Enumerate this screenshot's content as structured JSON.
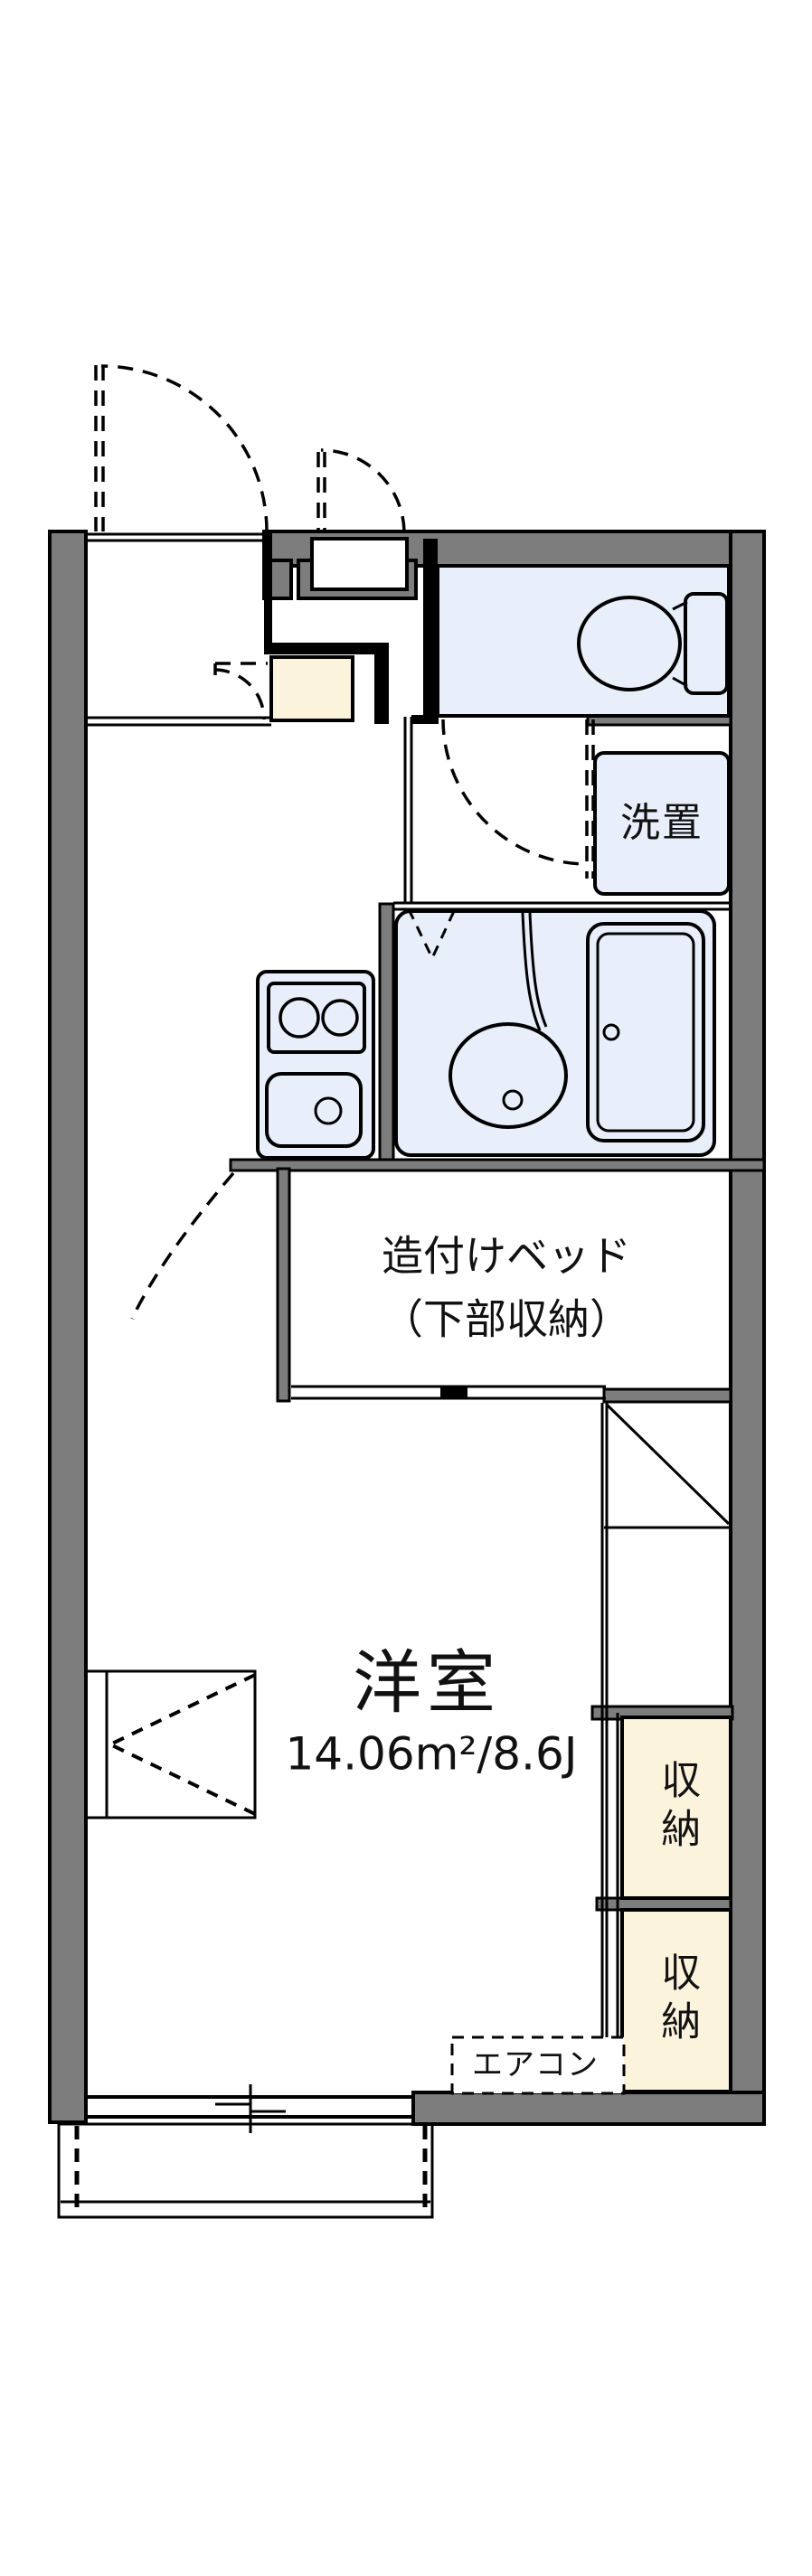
{
  "document": {
    "kind": "japanese-apartment-floor-plan"
  },
  "colors": {
    "wall_gray": "#7d7d7d",
    "fixture_fill": "#e8effb",
    "storage_fill": "#fcf3dd",
    "line_black": "#000000",
    "background": "#ffffff"
  },
  "labels": {
    "washstand": "洗置",
    "bed_line1": "造付けベッド",
    "bed_line2": "（下部収納）",
    "room_name": "洋室",
    "room_area": "14.06m²/8.6J",
    "storage_upper": "収納",
    "storage_lower": "収納",
    "aircon": "エアコン"
  },
  "rooms": [
    {
      "name": "toilet-room",
      "fill": "#e8effb"
    },
    {
      "name": "washstand-area",
      "label": "洗置",
      "fill": "#e8effb"
    },
    {
      "name": "bathroom-unit",
      "fill": "#e8effb"
    },
    {
      "name": "kitchen-area",
      "fill": "#ffffff"
    },
    {
      "name": "entrance-hall",
      "fill": "#ffffff"
    },
    {
      "name": "genkan-step",
      "fill": "#fcf3dd"
    },
    {
      "name": "built-in-bed",
      "label": "造付けベッド（下部収納）",
      "fill": "#ffffff"
    },
    {
      "name": "western-room",
      "label": "洋室",
      "area": "14.06m²/8.6J",
      "fill": "#ffffff"
    },
    {
      "name": "storage-upper",
      "label": "収納",
      "fill": "#fcf3dd"
    },
    {
      "name": "storage-lower",
      "label": "収納",
      "fill": "#fcf3dd"
    },
    {
      "name": "balcony",
      "fill": "#ffffff"
    }
  ],
  "fixtures": [
    "toilet-icon",
    "washstand-unit-icon",
    "bathtub-icon",
    "bath-basin-icon",
    "stove-two-burner-icon",
    "kitchen-sink-icon",
    "aircon-dashed-box",
    "entrance-door-swing-arc",
    "meterbox-door-swing-arc",
    "genkan-door-swing-arc",
    "toilet-door-swing-arc",
    "room-door-swing-arc",
    "window-sliding-bottom",
    "desk-counter-box"
  ]
}
